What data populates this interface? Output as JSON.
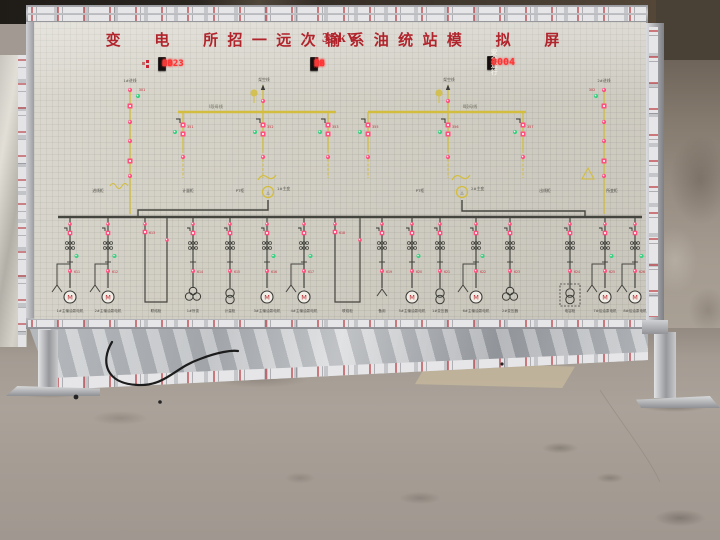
{
  "title_board": {
    "part1": "招 远 输 油 站",
    "part2": "35kV",
    "part3": "变 电 所 一 次 系 统 模 拟 屏",
    "color": "#b1242c"
  },
  "displays": {
    "date": {
      "year": "2023",
      "year_unit": "年",
      "month": "03",
      "month_unit": "月",
      "day": "03",
      "day_unit": "日"
    },
    "time": {
      "hour": "16",
      "hour_unit": "时",
      "minute": "12",
      "minute_unit": "分",
      "second": "08",
      "second_unit": "秒",
      "week_label": "星期",
      "week_value": "5"
    },
    "safety": {
      "label": "安全运行",
      "days": "0004",
      "unit": "天"
    }
  },
  "diagram": {
    "colors": {
      "hv": "#d3bd3e",
      "lv": "#45453f",
      "red": "#ff4f7e",
      "green": "#35d17f"
    },
    "hv": {
      "buses": [
        {
          "x1": 178,
          "x2": 336,
          "y": 112,
          "label": "Ⅰ段母线",
          "lx": 216
        },
        {
          "x1": 368,
          "x2": 526,
          "y": 112,
          "label": "Ⅱ段母线",
          "lx": 470
        }
      ],
      "incomings": [
        {
          "x": 263,
          "label": "架空线"
        },
        {
          "x": 448,
          "label": "架空线"
        }
      ],
      "edges": [
        {
          "x": 130,
          "side": "left",
          "label": "1#进线",
          "code": "301"
        },
        {
          "x": 604,
          "side": "right",
          "label": "2#进线",
          "code": "302"
        }
      ],
      "drops": [
        {
          "x": 183,
          "code": "351"
        },
        {
          "x": 263,
          "code": "352"
        },
        {
          "x": 328,
          "code": "353"
        },
        {
          "x": 368,
          "code": "355"
        },
        {
          "x": 448,
          "code": "356"
        },
        {
          "x": 523,
          "code": "357"
        }
      ],
      "transformers": [
        {
          "x": 268,
          "y": 188,
          "label": "1#主变"
        },
        {
          "x": 462,
          "y": 188,
          "label": "2#主变"
        }
      ]
    },
    "lv": {
      "bus": {
        "x1": 58,
        "x2": 642,
        "y": 217
      },
      "links": [
        "M268,200 V210 H138 V217",
        "M462,200 V211 H585 V217"
      ],
      "cab_labels": [
        {
          "x": 98,
          "y": 192,
          "t": "进线柜"
        },
        {
          "x": 188,
          "y": 192,
          "t": "计量柜"
        },
        {
          "x": 240,
          "y": 192,
          "t": "PT柜"
        },
        {
          "x": 420,
          "y": 192,
          "t": "PT柜"
        },
        {
          "x": 545,
          "y": 192,
          "t": "出线柜"
        },
        {
          "x": 612,
          "y": 192,
          "t": "所变柜"
        }
      ],
      "feeders": [
        {
          "x": 70,
          "sym": "motor",
          "fork": true,
          "green": true,
          "code": "611",
          "label": "1#主输油泵电机"
        },
        {
          "x": 108,
          "sym": "motor",
          "fork": true,
          "green": true,
          "code": "612",
          "label": "2#主输油泵电机"
        },
        {
          "x": 145,
          "x2": 167,
          "sym": "utie",
          "code": "613",
          "label": "联络柜"
        },
        {
          "x": 193,
          "sym": "xfmr3",
          "code": "614",
          "label": "1#所变"
        },
        {
          "x": 230,
          "sym": "xfmr2v",
          "code": "615",
          "label": "计量柜"
        },
        {
          "x": 267,
          "sym": "motor",
          "green": true,
          "code": "616",
          "label": "3#主输油泵电机"
        },
        {
          "x": 304,
          "sym": "motor",
          "fork": true,
          "green": true,
          "code": "617",
          "label": "4#主输油泵电机"
        },
        {
          "x": 335,
          "x2": 360,
          "sym": "utie",
          "code": "618",
          "label": "联络柜"
        },
        {
          "x": 382,
          "sym": "fork",
          "code": "619",
          "label": "备用"
        },
        {
          "x": 412,
          "sym": "motor",
          "green": true,
          "code": "620",
          "label": "5#主输油泵电机"
        },
        {
          "x": 440,
          "sym": "xfmr2v",
          "code": "621",
          "label": "1#变压器"
        },
        {
          "x": 476,
          "sym": "motor",
          "fork": true,
          "green": true,
          "code": "622",
          "label": "6#主输油泵电机"
        },
        {
          "x": 510,
          "sym": "xfmr3",
          "code": "623",
          "label": "2#变压器"
        },
        {
          "x": 570,
          "sym": "xfmr2v",
          "boxed": true,
          "code": "624",
          "label": "电容柜"
        },
        {
          "x": 605,
          "sym": "motor",
          "fork": true,
          "green": true,
          "code": "625",
          "label": "7#给油泵电机"
        },
        {
          "x": 635,
          "sym": "motor",
          "fork": true,
          "green": true,
          "code": "626",
          "label": "8#给油泵电机"
        }
      ]
    }
  },
  "scene": {
    "cable_color": "#1c1c1c",
    "cable_path": "M112,342 C100,362 106,384 138,385 C166,386 174,368 200,359 C218,352 232,350 238,351",
    "floor_dots": [
      [
        76,
        397,
        2.4
      ],
      [
        502,
        364,
        1.6
      ],
      [
        160,
        402,
        1.8
      ]
    ],
    "crack_path": "M600,390 C622,424 648,456 660,482"
  }
}
